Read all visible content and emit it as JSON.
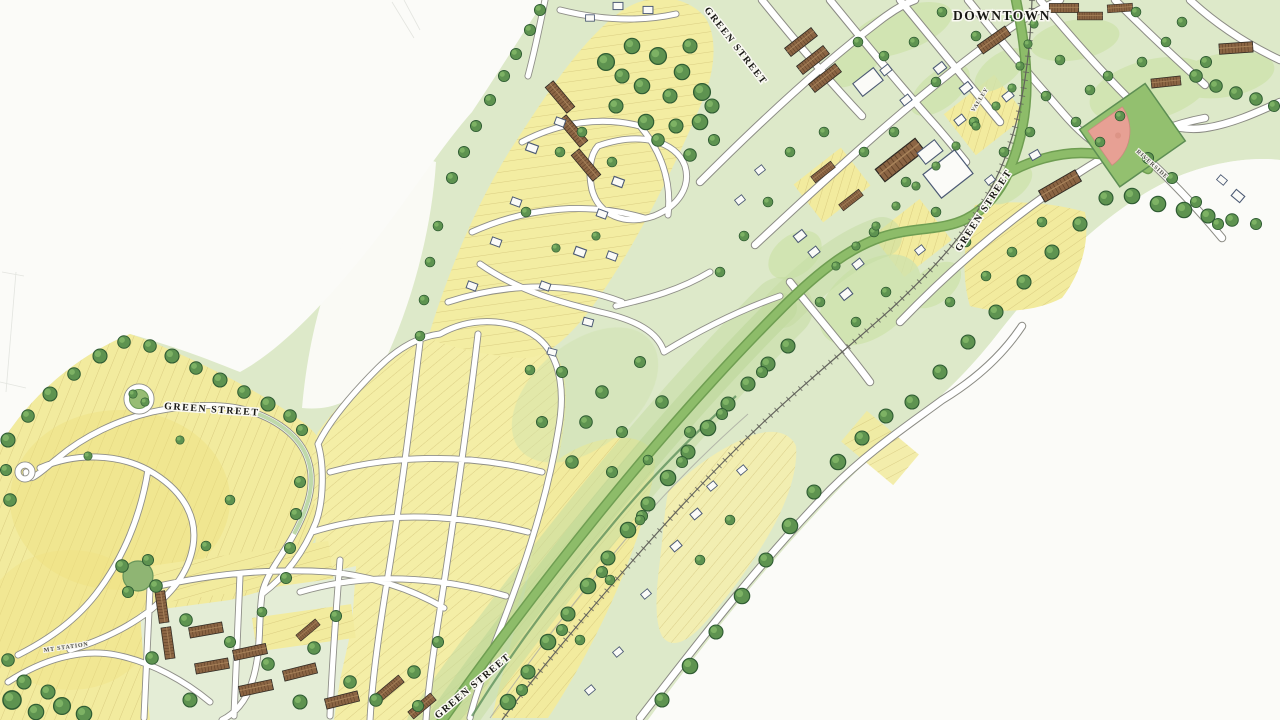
{
  "app": {
    "type": "illustrative-watercolor-master-plan-map",
    "description": "Hand-rendered neighborhood master plan showing a green street corridor linking a residential subdivision to downtown"
  },
  "map": {
    "area_labels": {
      "downtown": "DOWNTOWN"
    },
    "street_labels": {
      "green_street": "GREEN STREET",
      "mt_station": "MT STATION",
      "riverside": "RIVERSIDE",
      "valley": "VALLEY"
    },
    "features": {
      "green_street_label_count": 4,
      "landmarks": [
        "baseball-field",
        "railroad",
        "greenway",
        "pond",
        "subdivision-loop",
        "downtown-grid"
      ]
    },
    "palette": {
      "paper": "#fbfbf8",
      "parcel_yellow": "#f2eb9e",
      "parcel_line": "#c3b066",
      "lawn_green": "#dde9c9",
      "park_green": "#cfe3ad",
      "forest_green": "#55904a",
      "forest_outline": "#2f5c33",
      "road_white": "#ffffff",
      "road_casing": "#8f8f88",
      "green_street_green": "#8dbc69",
      "railroad_gray": "#63635c",
      "building_brown": "#8b6544",
      "building_white": "#fbfbf8",
      "infield_clay": "#e7a094",
      "label_ink": "#181814"
    }
  }
}
